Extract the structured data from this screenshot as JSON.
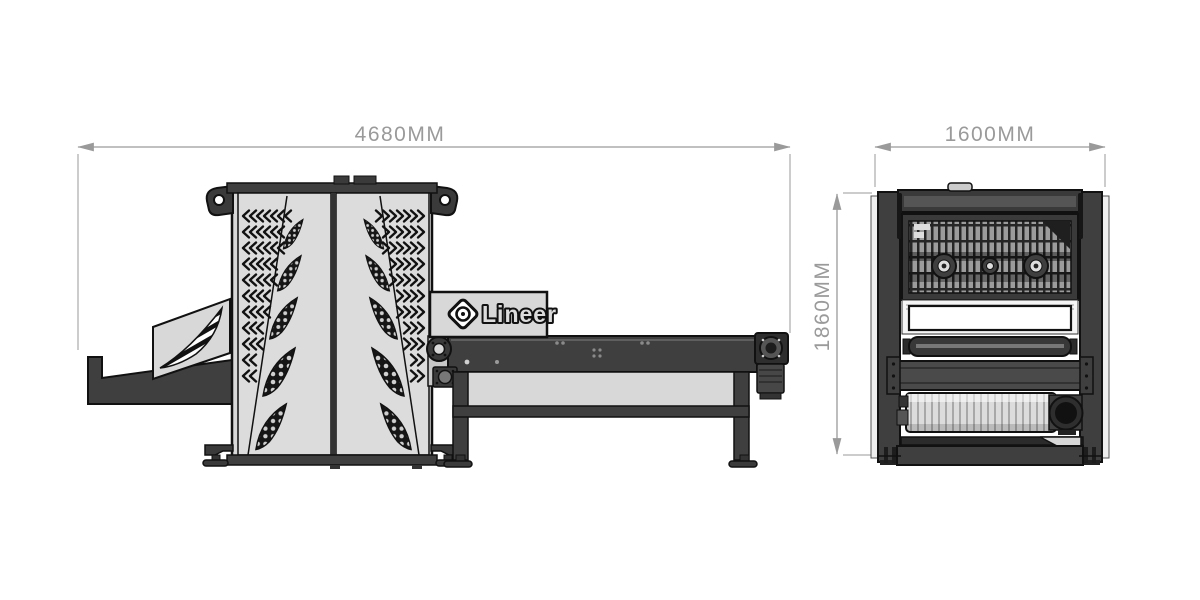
{
  "views": {
    "side": {
      "overall_width_label": "4680MM",
      "brand": {
        "name": "Lineer",
        "icon": "lineer-diamond-logo-icon"
      }
    },
    "front": {
      "overall_width_label": "1600MM",
      "overall_height_label": "1860MM"
    }
  },
  "colors": {
    "background": "#ffffff",
    "dimension_line": "#9a9a9a",
    "outline": "#111111",
    "dark_steel": "#3f3f3f",
    "light_panel": "#d8d8d8",
    "white_panel": "#ffffff"
  }
}
